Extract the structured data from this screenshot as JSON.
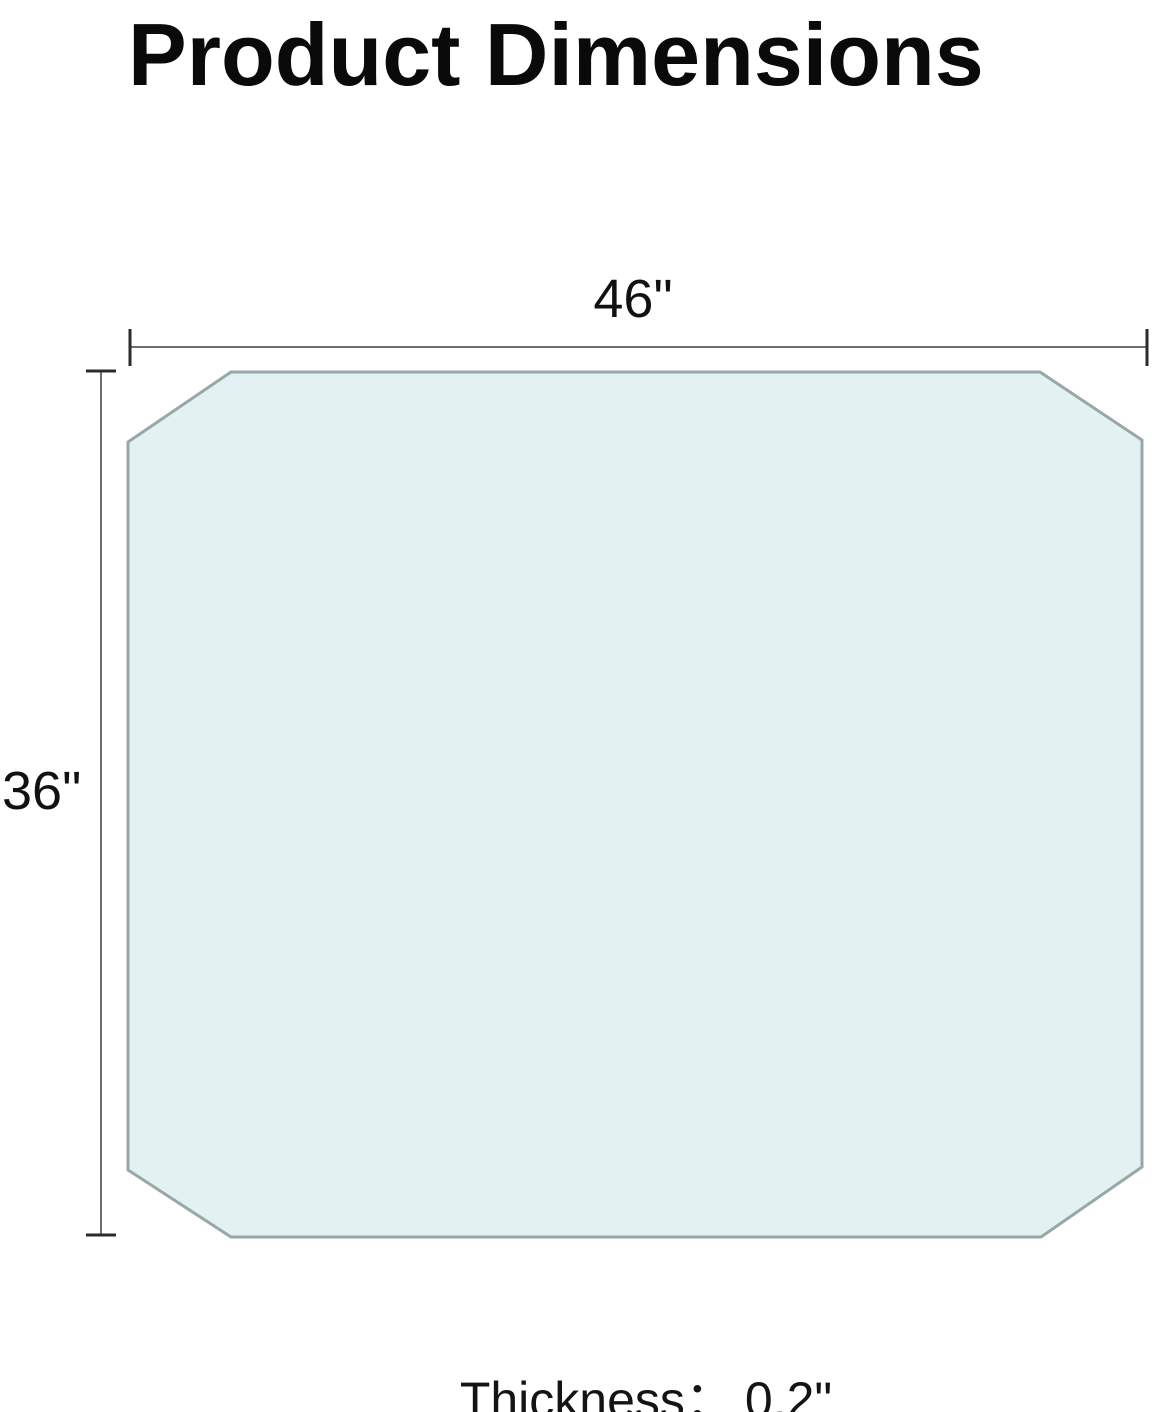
{
  "title": "Product Dimensions",
  "diagram": {
    "shape": "octagon",
    "width_label": "46\"",
    "height_label": "36\""
  },
  "footer": {
    "thickness_label": "Thickness：",
    "thickness_value": "0.2\""
  },
  "colors": {
    "shape_fill": "#e4f1f2",
    "shape_border": "#98a7a8",
    "dimension_line": "#6e6e6e",
    "text": "#111111",
    "title_text": "#0a0a0a"
  }
}
